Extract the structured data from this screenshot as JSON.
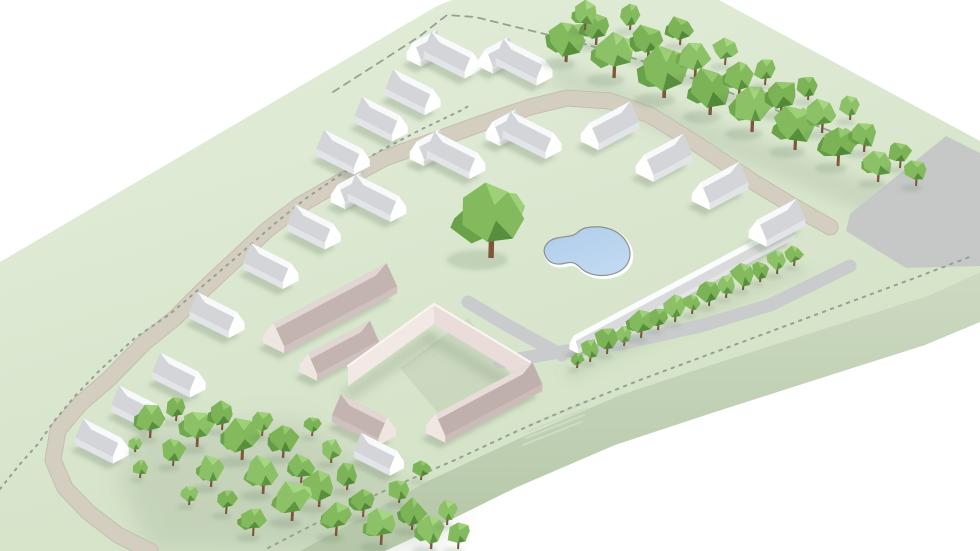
{
  "meta": {
    "title": "low-poly-3d-site-masterplan-render",
    "canvas": {
      "w": 980,
      "h": 551
    }
  },
  "colors": {
    "bg": "#ffffff",
    "slab_top_light": "#e4eedb",
    "slab_top_dark": "#d2e1c5",
    "slab_side_light": "#ccdac1",
    "slab_side_dark": "#b5c7a8",
    "road_beige": "#d3cec0",
    "road_beige_edge": "#c4beae",
    "road_gray": "#c6c8c8",
    "path_gray": "#c9cbcc",
    "dash": "#96a096",
    "water_a": "#aecdec",
    "water_b": "#c2d9f1",
    "pond_rim_dark": "#8e928b",
    "pond_rim_light": "#ffffff",
    "trunk": "#7d5737",
    "shadow": "rgba(105,125,100,0.28)",
    "lawn_shade": "rgba(115,135,108,0.16)",
    "stairs": "#cfdcc4"
  },
  "palettes": {
    "house": {
      "light": "#f8f9fa",
      "dark": "#d3d5d9",
      "end": "#ffffff",
      "wall": "#e2e4e8"
    },
    "pink": {
      "light": "#e2d6d2",
      "dark": "#c3b4b0",
      "end": "#efe5e1",
      "wall": "#cfc1bd"
    },
    "pinkFront": {
      "light": "#e8dcd8",
      "dark": "#c0b0ac",
      "end": "#f0e6e2",
      "wall": "#cbbcb8"
    },
    "wallPrism": {
      "light": "#fbfcfc",
      "dark": "#d8dadb",
      "end": "#ffffff",
      "wall": "#e2e4e6"
    },
    "tree": [
      {
        "base": "#84ba5e",
        "light": "#9ed077",
        "dark": "#6aa24a",
        "darker": "#588f3d"
      },
      {
        "base": "#7cb356",
        "light": "#95c86f",
        "dark": "#639c44",
        "darker": "#528839"
      },
      {
        "base": "#8cc167",
        "light": "#a6d681",
        "dark": "#71a94f",
        "darker": "#5d9542"
      }
    ]
  },
  "axes": {
    "A": {
      "x": 0.893,
      "y": 0.45
    },
    "B": {
      "x": 0.883,
      "y": -0.469
    }
  },
  "slab": {
    "top": [
      [
        0,
        262
      ],
      [
        437,
        6
      ],
      [
        452,
        0
      ],
      [
        719,
        0
      ],
      [
        980,
        141
      ],
      [
        980,
        272
      ],
      [
        930,
        295
      ],
      [
        820,
        330
      ],
      [
        720,
        362
      ],
      [
        620,
        395
      ],
      [
        520,
        438
      ],
      [
        430,
        480
      ],
      [
        300,
        551
      ],
      [
        0,
        551
      ]
    ],
    "side": [
      [
        300,
        551
      ],
      [
        430,
        480
      ],
      [
        520,
        438
      ],
      [
        620,
        395
      ],
      [
        720,
        362
      ],
      [
        820,
        330
      ],
      [
        930,
        295
      ],
      [
        980,
        272
      ],
      [
        980,
        322
      ],
      [
        925,
        345
      ],
      [
        815,
        380
      ],
      [
        715,
        412
      ],
      [
        615,
        445
      ],
      [
        515,
        488
      ],
      [
        430,
        530
      ],
      [
        385,
        551
      ]
    ]
  },
  "lawn_shades": [
    {
      "pts": [
        [
          555,
          60
        ],
        [
          900,
          195
        ],
        [
          880,
          218
        ],
        [
          545,
          85
        ]
      ],
      "blur": 8,
      "alpha": 0.16
    },
    {
      "pts": [
        [
          140,
          430
        ],
        [
          300,
          420
        ],
        [
          460,
          520
        ],
        [
          430,
          551
        ],
        [
          150,
          551
        ],
        [
          118,
          480
        ]
      ],
      "blur": 12,
      "alpha": 0.18
    },
    {
      "pts": [
        [
          400,
          368
        ],
        [
          468,
          318
        ],
        [
          520,
          388
        ],
        [
          452,
          430
        ]
      ],
      "blur": 6,
      "alpha": 0.12
    },
    {
      "pts": [
        [
          560,
          370
        ],
        [
          800,
          262
        ],
        [
          812,
          274
        ],
        [
          572,
          382
        ]
      ],
      "blur": 5,
      "alpha": 0.1
    }
  ],
  "roads": {
    "gray_road": [
      [
        946,
        136
      ],
      [
        980,
        153
      ],
      [
        980,
        266
      ],
      [
        906,
        268
      ],
      [
        846,
        231
      ],
      [
        850,
        214
      ]
    ],
    "arc": [
      [
        150,
        551
      ],
      [
        118,
        535
      ],
      [
        88,
        512
      ],
      [
        65,
        488
      ],
      [
        53,
        460
      ],
      [
        58,
        430
      ],
      [
        80,
        404
      ],
      [
        110,
        378
      ],
      [
        145,
        342
      ],
      [
        175,
        318
      ],
      [
        205,
        288
      ],
      [
        235,
        260
      ],
      [
        267,
        230
      ],
      [
        300,
        205
      ],
      [
        340,
        182
      ],
      [
        385,
        158
      ],
      [
        430,
        142
      ],
      [
        480,
        124
      ],
      [
        530,
        107
      ],
      [
        567,
        98
      ],
      [
        610,
        101
      ],
      [
        650,
        115
      ],
      [
        700,
        146
      ],
      [
        755,
        183
      ],
      [
        800,
        210
      ],
      [
        830,
        227
      ]
    ],
    "arc_width": 15,
    "path_p": [
      [
        468,
        302
      ],
      [
        505,
        324
      ],
      [
        545,
        346
      ],
      [
        562,
        355
      ]
    ],
    "wall_path": [
      [
        500,
        362
      ],
      [
        560,
        352
      ],
      [
        620,
        344
      ],
      [
        700,
        326
      ],
      [
        770,
        305
      ],
      [
        850,
        266
      ]
    ],
    "path_width": 13,
    "stairs": {
      "x1": 532,
      "y1": 424,
      "x2": 590,
      "y2": 401,
      "dx": -3,
      "dy": 7,
      "n": 4
    }
  },
  "boundary": {
    "dots_road": [
      [
        0,
        489
      ],
      [
        20,
        464
      ],
      [
        38,
        444
      ],
      [
        55,
        420
      ],
      [
        75,
        396
      ],
      [
        100,
        370
      ],
      [
        135,
        338
      ],
      [
        170,
        314
      ],
      [
        205,
        284
      ],
      [
        240,
        254
      ],
      [
        272,
        226
      ],
      [
        305,
        199
      ],
      [
        340,
        175
      ],
      [
        378,
        152
      ],
      [
        420,
        130
      ],
      [
        462,
        110
      ],
      [
        470,
        105
      ]
    ],
    "dash_top": [
      [
        333,
        92
      ],
      [
        380,
        62
      ],
      [
        420,
        36
      ],
      [
        447,
        15
      ],
      [
        475,
        17
      ],
      [
        520,
        28
      ],
      [
        570,
        40
      ],
      [
        620,
        54
      ],
      [
        670,
        70
      ],
      [
        760,
        104
      ],
      [
        820,
        127
      ],
      [
        870,
        147
      ]
    ],
    "dots_front": [
      [
        268,
        548
      ],
      [
        330,
        516
      ],
      [
        395,
        486
      ],
      [
        455,
        460
      ],
      [
        515,
        432
      ],
      [
        570,
        408
      ],
      [
        640,
        380
      ],
      [
        710,
        354
      ],
      [
        780,
        328
      ],
      [
        850,
        302
      ],
      [
        920,
        276
      ],
      [
        972,
        256
      ]
    ]
  },
  "pond": {
    "path": "M 585,228 C 603,224 620,230 627,243 C 633,254 630,266 618,272 C 608,277 593,277 583,270 C 577,265 575,261 566,263 C 556,266 548,263 545,255 C 542,247 548,240 557,238 C 566,236 572,237 577,233 C 580,230 582,229 585,228 Z"
  },
  "pink_complex": {
    "bars": [
      {
        "axis": "B",
        "cx": 330,
        "cy": 318,
        "L": 128,
        "W": 24,
        "pal": "pink"
      },
      {
        "axis": "B",
        "cx": 339,
        "cy": 360,
        "L": 70,
        "W": 20,
        "pal": "pink"
      },
      {
        "axis": "B",
        "cx": 484,
        "cy": 412,
        "L": 110,
        "W": 22,
        "pal": "pinkFront"
      },
      {
        "axis": "A",
        "cx": 364,
        "cy": 429,
        "L": 52,
        "W": 20,
        "pal": "pink"
      },
      {
        "axis": "A",
        "cx": 379,
        "cy": 463,
        "L": 40,
        "W": 16,
        "pal": "house"
      }
    ],
    "tall_wings": [
      {
        "face": [
          [
            348,
            386
          ],
          [
            434,
            324
          ],
          [
            434,
            304
          ],
          [
            348,
            366
          ]
        ],
        "fill": "#f2e8e4",
        "topEdge": [
          [
            348,
            366
          ],
          [
            434,
            304
          ]
        ]
      },
      {
        "face": [
          [
            434,
            324
          ],
          [
            530,
            382
          ],
          [
            530,
            362
          ],
          [
            434,
            304
          ]
        ],
        "fill": "#eadcd8",
        "topEdge": [
          [
            434,
            304
          ],
          [
            530,
            362
          ]
        ]
      }
    ],
    "wing_shadows": [
      [
        [
          340,
          392
        ],
        [
          428,
          330
        ],
        [
          438,
          342
        ],
        [
          350,
          402
        ]
      ],
      [
        [
          430,
          330
        ],
        [
          526,
          388
        ],
        [
          518,
          398
        ],
        [
          424,
          340
        ]
      ]
    ]
  },
  "wall": {
    "axis": "B",
    "cx": 682,
    "cy": 294,
    "L": 245,
    "W": 10,
    "eh": 5,
    "rh": 11,
    "pal": "wallPrism"
  },
  "houses": [
    {
      "type": "L",
      "axis": "A",
      "cx": 452,
      "cy": 64,
      "L": 46,
      "W": 18
    },
    {
      "type": "L",
      "axis": "A",
      "cx": 524,
      "cy": 71,
      "L": 46,
      "W": 18
    },
    {
      "type": "bar",
      "axis": "A",
      "cx": 413,
      "cy": 101,
      "L": 44,
      "W": 18
    },
    {
      "type": "bar",
      "axis": "A",
      "cx": 381,
      "cy": 128,
      "L": 42,
      "W": 18
    },
    {
      "type": "bar",
      "axis": "A",
      "cx": 343,
      "cy": 161,
      "L": 42,
      "W": 18
    },
    {
      "type": "bar",
      "axis": "A",
      "cx": 314,
      "cy": 236,
      "L": 42,
      "W": 18
    },
    {
      "type": "bar",
      "axis": "A",
      "cx": 271,
      "cy": 275,
      "L": 44,
      "W": 18
    },
    {
      "type": "bar",
      "axis": "A",
      "cx": 217,
      "cy": 324,
      "L": 44,
      "W": 18
    },
    {
      "type": "L",
      "axis": "A",
      "cx": 377,
      "cy": 207,
      "L": 48,
      "W": 18
    },
    {
      "type": "L",
      "axis": "A",
      "cx": 456,
      "cy": 164,
      "L": 48,
      "W": 18
    },
    {
      "type": "L",
      "axis": "A",
      "cx": 532,
      "cy": 144,
      "L": 48,
      "W": 18
    },
    {
      "type": "bar",
      "axis": "B",
      "cx": 610,
      "cy": 135,
      "L": 46,
      "W": 20
    },
    {
      "type": "bar",
      "axis": "B",
      "cx": 664,
      "cy": 167,
      "L": 44,
      "W": 20
    },
    {
      "type": "bar",
      "axis": "B",
      "cx": 720,
      "cy": 195,
      "L": 44,
      "W": 20
    },
    {
      "type": "bar",
      "axis": "B",
      "cx": 777,
      "cy": 232,
      "L": 44,
      "W": 20
    },
    {
      "type": "bar",
      "axis": "A",
      "cx": 179,
      "cy": 384,
      "L": 42,
      "W": 18
    },
    {
      "type": "bar",
      "axis": "A",
      "cx": 138,
      "cy": 417,
      "L": 42,
      "W": 18
    },
    {
      "type": "bar",
      "axis": "A",
      "cx": 102,
      "cy": 450,
      "L": 42,
      "W": 18
    }
  ],
  "trees": [
    [
      566,
      62,
      19,
      0
    ],
    [
      596,
      45,
      15,
      1
    ],
    [
      614,
      78,
      21,
      2
    ],
    [
      648,
      60,
      16,
      1
    ],
    [
      664,
      98,
      23,
      0
    ],
    [
      695,
      78,
      17,
      2
    ],
    [
      710,
      115,
      21,
      1
    ],
    [
      739,
      97,
      16,
      0
    ],
    [
      752,
      132,
      21,
      2
    ],
    [
      781,
      114,
      16,
      1
    ],
    [
      795,
      150,
      20,
      0
    ],
    [
      822,
      133,
      15,
      2
    ],
    [
      838,
      166,
      18,
      1
    ],
    [
      864,
      152,
      14,
      0
    ],
    [
      878,
      182,
      15,
      2
    ],
    [
      900,
      168,
      12,
      1
    ],
    [
      916,
      186,
      12,
      0
    ],
    [
      585,
      30,
      13,
      2
    ],
    [
      630,
      30,
      12,
      0
    ],
    [
      680,
      45,
      13,
      1
    ],
    [
      725,
      65,
      12,
      2
    ],
    [
      765,
      85,
      12,
      0
    ],
    [
      808,
      100,
      11,
      1
    ],
    [
      850,
      120,
      11,
      2
    ],
    [
      590,
      362,
      10,
      0
    ],
    [
      607,
      354,
      12,
      1
    ],
    [
      624,
      346,
      9,
      2
    ],
    [
      641,
      338,
      13,
      0
    ],
    [
      658,
      330,
      10,
      1
    ],
    [
      675,
      322,
      12,
      2
    ],
    [
      692,
      314,
      9,
      0
    ],
    [
      709,
      306,
      12,
      1
    ],
    [
      726,
      298,
      10,
      2
    ],
    [
      743,
      290,
      12,
      0
    ],
    [
      760,
      282,
      9,
      1
    ],
    [
      777,
      274,
      11,
      2
    ],
    [
      794,
      266,
      9,
      0
    ],
    [
      577,
      368,
      7,
      1
    ],
    [
      150,
      438,
      15,
      0
    ],
    [
      176,
      421,
      11,
      1
    ],
    [
      197,
      447,
      17,
      2
    ],
    [
      173,
      466,
      12,
      0
    ],
    [
      222,
      430,
      13,
      1
    ],
    [
      242,
      460,
      19,
      0
    ],
    [
      211,
      487,
      14,
      2
    ],
    [
      262,
      436,
      11,
      0
    ],
    [
      283,
      458,
      15,
      1
    ],
    [
      263,
      494,
      17,
      2
    ],
    [
      301,
      483,
      13,
      0
    ],
    [
      312,
      436,
      9,
      1
    ],
    [
      331,
      463,
      11,
      2
    ],
    [
      319,
      507,
      16,
      0
    ],
    [
      347,
      490,
      12,
      1
    ],
    [
      292,
      521,
      18,
      2
    ],
    [
      336,
      536,
      15,
      0
    ],
    [
      363,
      517,
      13,
      1
    ],
    [
      381,
      545,
      16,
      2
    ],
    [
      399,
      503,
      11,
      0
    ],
    [
      412,
      530,
      14,
      1
    ],
    [
      431,
      549,
      15,
      2
    ],
    [
      253,
      536,
      13,
      0
    ],
    [
      226,
      514,
      11,
      1
    ],
    [
      189,
      505,
      9,
      2
    ],
    [
      140,
      478,
      8,
      0
    ],
    [
      421,
      480,
      9,
      1
    ],
    [
      447,
      525,
      11,
      2
    ],
    [
      458,
      549,
      12,
      0
    ],
    [
      135,
      452,
      7,
      2
    ]
  ],
  "center_tree": {
    "x": 491,
    "y": 258,
    "r": 34,
    "v": 0
  }
}
